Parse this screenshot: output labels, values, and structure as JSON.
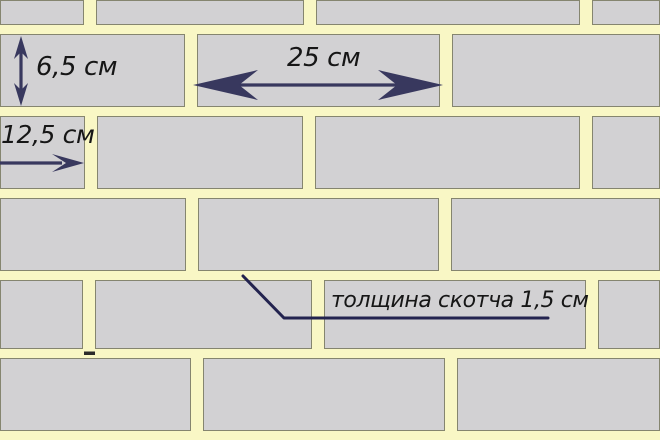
{
  "diagram": {
    "type": "brick-wall-dimension-diagram",
    "labels": {
      "brick_height": "6,5 см",
      "brick_length": "25 см",
      "half_brick_length": "12,5 см",
      "tape_thickness": "толщина скотча 1,5 см"
    },
    "colors": {
      "mortar": "#F9F7C5",
      "brick": "#D2D1D3",
      "brick_border": "#85856F",
      "dimension": "#38385E",
      "callout": "#23234F",
      "text": "#161616"
    },
    "wall": {
      "width": 660,
      "height": 440,
      "vertical_joint_width": 12,
      "rows": [
        {
          "top": 0,
          "height": 25,
          "joints": [
            90,
            310,
            586
          ]
        },
        {
          "top": 34,
          "height": 73,
          "joints": [
            191,
            446
          ]
        },
        {
          "top": 116,
          "height": 73,
          "joints": [
            91,
            309,
            586
          ]
        },
        {
          "top": 198,
          "height": 73,
          "joints": [
            192,
            445
          ]
        },
        {
          "top": 280,
          "height": 69,
          "joints": [
            89,
            318,
            592
          ]
        },
        {
          "top": 358,
          "height": 73,
          "joints": [
            197,
            451
          ]
        }
      ]
    }
  }
}
